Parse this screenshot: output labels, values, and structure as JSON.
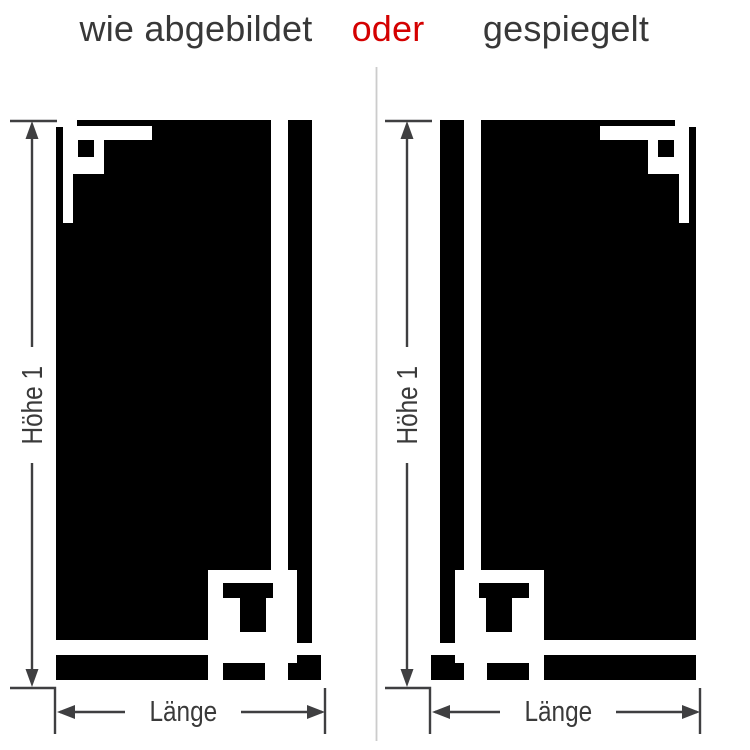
{
  "title": {
    "option_as_depicted": "wie abgebildet",
    "connector": "oder",
    "option_mirrored": "gespiegelt"
  },
  "panel_left": {
    "height_label": "Höhe 1",
    "length_label": "Länge"
  },
  "panel_right": {
    "height_label": "Höhe 1",
    "length_label": "Länge"
  },
  "colors": {
    "background": "#ffffff",
    "decal": "#000000",
    "dimension_lines": "#3f3f41",
    "label_text": "#3a3a3a",
    "title_text": "#383838",
    "accent_red": "#d40000",
    "divider": "#cccccc"
  }
}
